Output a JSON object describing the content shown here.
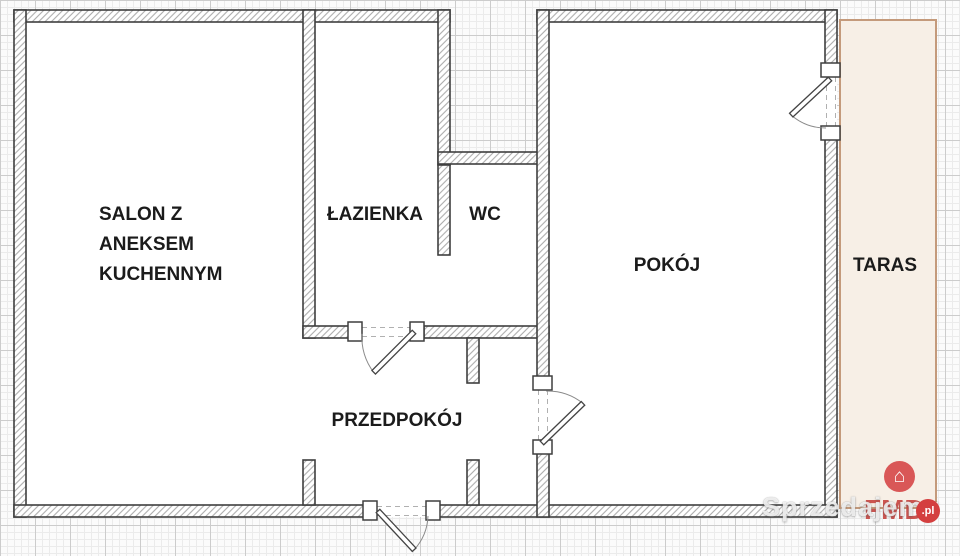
{
  "rooms": {
    "salon": {
      "label": "SALON Z\nANEKSEM\nKUCHENNYM"
    },
    "lazienka": {
      "label": "ŁAZIENKA"
    },
    "wc": {
      "label": "WC"
    },
    "pokoj": {
      "label": "POKÓJ"
    },
    "przedpokoj": {
      "label": "PRZEDPOKÓJ"
    },
    "taras": {
      "label": "TARAS"
    }
  },
  "watermark": {
    "text": "Sprzedajemy"
  },
  "branding": {
    "name": "FMD",
    "suffix": ".pl",
    "icon": "house-icon"
  },
  "colors": {
    "taras_fill": "#f7efe6",
    "taras_border": "#c49a7b",
    "wall_outline": "#3f3f3f",
    "hatch_line": "#9b9b9b",
    "logo_red": "#d95757",
    "grid_minor": "#ebebeb",
    "grid_major": "#cccccc",
    "label_text": "#1b1b1b"
  }
}
